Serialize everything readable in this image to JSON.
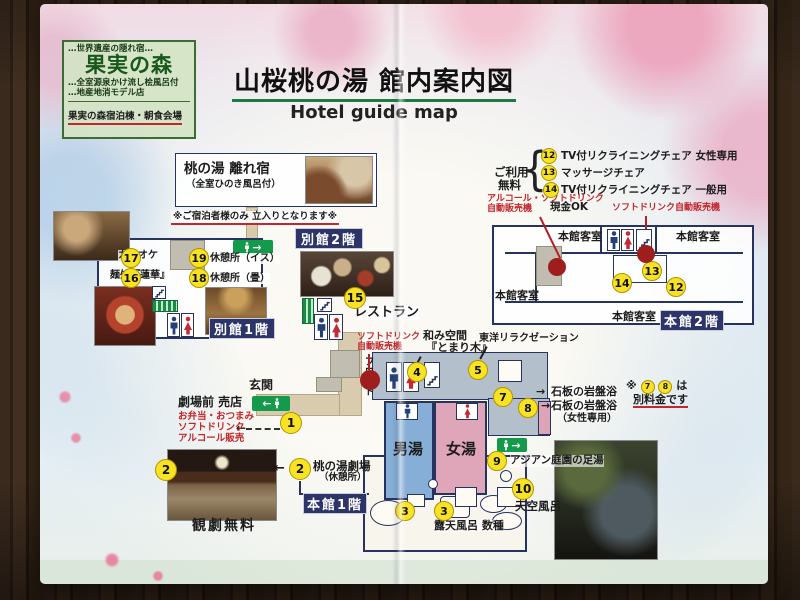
{
  "header": {
    "title": "山桜桃の湯 館内案内図",
    "subtitle": "Hotel guide map"
  },
  "kajitsu": {
    "tagline": "…世界遺産の隠れ宿…",
    "name": "果実の森",
    "feature1": "…全室源泉かけ流し桧風呂付",
    "feature2": "…地産地消モデル店",
    "venue": "果実の森宿泊棟・朝食会場"
  },
  "hanare": {
    "title": "桃の湯 離れ宿",
    "subtitle": "（全室ひのき風呂付）",
    "note": "※ご宿泊者様のみ 立入りとなります※"
  },
  "free_use": {
    "label1": "ご利用",
    "label2": "無料",
    "brace": "{",
    "items": [
      {
        "num": "12",
        "label": "TV付リクライニングチェア 女性専用"
      },
      {
        "num": "13",
        "label": "マッサージチェア"
      },
      {
        "num": "14",
        "label": "TV付リクライニングチェア 一般用"
      }
    ]
  },
  "vending": {
    "alcohol1": "アルコール・ソフトドリンク",
    "alcohol2": "自動販売機",
    "cash": "現金OK",
    "soft": "ソフトドリンク自動販売機",
    "soft_c1": "ソフトドリンク",
    "soft_c2": "自動販売機"
  },
  "honkan2f": {
    "floor": "本館2階",
    "room": "本館客室",
    "n12": "12",
    "n13": "13",
    "n14": "14"
  },
  "bekkan": {
    "floor1": "別館1階",
    "floor2": "別館2階",
    "karaoke": "カラオケ",
    "noodle": "麺処『蓮華』",
    "n17": "17",
    "n19": "19",
    "n16": "16",
    "n18": "18",
    "rest_chair": "休憩所（イス）",
    "rest_tatami": "休憩所（畳）",
    "n15": "15",
    "restaurant": "レストラン"
  },
  "center": {
    "entrance": "玄関",
    "front": "フロント",
    "n1": "1",
    "shop_title": "劇場前 売店",
    "shop1": "お弁当・おつまみ",
    "shop2": "ソフトドリンク",
    "shop3": "アルコール販売",
    "n2": "2",
    "theater": "桃の湯劇場",
    "theater_sub": "（休憩所）",
    "theater_free": "観劇無料",
    "floor": "本館1階",
    "arrow_left": "←"
  },
  "baths": {
    "male": "男湯",
    "female": "女湯",
    "n3": "3",
    "rotenburo": "露天風呂 数種",
    "n4": "4",
    "nagomi1": "和み空間",
    "nagomi2": "『とまり木』",
    "n5": "5",
    "toyo": "東洋リラクゼーション",
    "n7": "7",
    "ganban1": "石板の岩盤浴",
    "n8": "8",
    "ganban2": "石板の岩盤浴",
    "ganban2_sub": "（女性専用）",
    "note_pre": "※",
    "note_post": "は",
    "note_line2": "別料金です",
    "n9": "9",
    "ashiyu": "アジアン庭園の足湯",
    "n10": "10",
    "tenku": "天空風呂",
    "arrow_right": "→"
  }
}
